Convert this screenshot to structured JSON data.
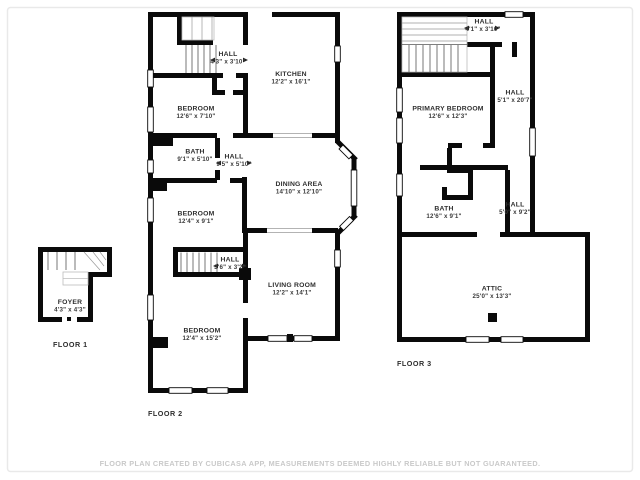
{
  "footer": {
    "text": "FLOOR PLAN CREATED BY CUBICASA APP, MEASUREMENTS DEEMED HIGHLY RELIABLE BUT NOT GUARANTEED."
  },
  "colors": {
    "wall": "#0a0a0a",
    "label": "#2e2e2e",
    "footer_text": "#c9c9c9",
    "frame": "#e9e9e9"
  },
  "floor1": {
    "label": "FLOOR 1",
    "rooms": {
      "foyer": {
        "name": "FOYER",
        "dims": "4'3\" x 4'3\""
      }
    }
  },
  "floor2": {
    "label": "FLOOR 2",
    "rooms": {
      "hall_top": {
        "name": "HALL",
        "dims": "4'3\" x 3'10\""
      },
      "kitchen": {
        "name": "KITCHEN",
        "dims": "12'2\" x 16'1\""
      },
      "bedroom_top": {
        "name": "BEDROOM",
        "dims": "12'6\" x 7'10\""
      },
      "bath": {
        "name": "BATH",
        "dims": "9'1\" x 5'10\""
      },
      "hall_mid": {
        "name": "HALL",
        "dims": "9'5\" x 5'10\""
      },
      "dining": {
        "name": "DINING AREA",
        "dims": "14'10\" x 12'10\""
      },
      "bedroom_mid": {
        "name": "BEDROOM",
        "dims": "12'4\" x 9'1\""
      },
      "hall_bottom": {
        "name": "HALL",
        "dims": "3'6\" x 3'2\""
      },
      "living": {
        "name": "LIVING ROOM",
        "dims": "12'2\" x 14'1\""
      },
      "bedroom_bottom": {
        "name": "BEDROOM",
        "dims": "12'4\" x 15'2\""
      }
    }
  },
  "floor3": {
    "label": "FLOOR 3",
    "rooms": {
      "hall_top": {
        "name": "HALL",
        "dims": "4'1\" x 3'10\""
      },
      "primary_bedroom": {
        "name": "PRIMARY BEDROOM",
        "dims": "12'6\" x 12'3\""
      },
      "hall_right": {
        "name": "HALL",
        "dims": "5'1\" x 20'7\""
      },
      "bath": {
        "name": "BATH",
        "dims": "12'6\" x 9'1\""
      },
      "hall_lower": {
        "name": "HALL",
        "dims": "5'0\" x 9'2\""
      },
      "attic": {
        "name": "ATTIC",
        "dims": "25'0\" x 13'3\""
      }
    }
  }
}
